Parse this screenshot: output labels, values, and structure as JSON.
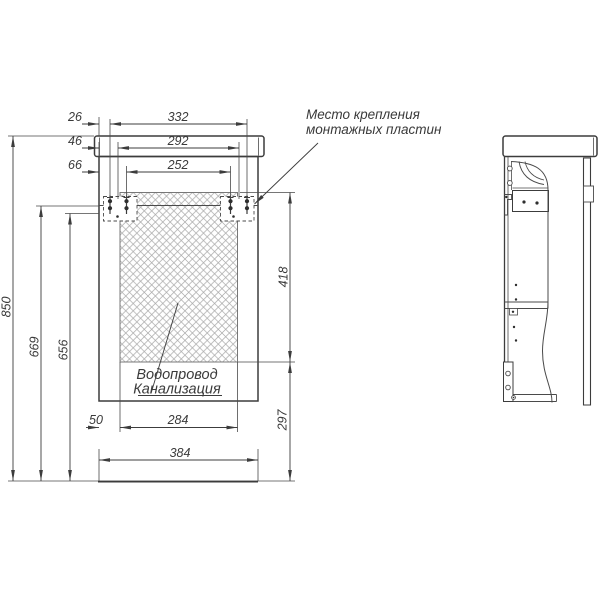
{
  "drawing": {
    "type": "technical-drawing",
    "subject": "wall-hung bathroom vanity installation drawing (front and side views)",
    "background": "#ffffff",
    "colors": {
      "line": "#3c3c3c",
      "thin_line": "#4a4a4a",
      "hatch": "#a8a8a8",
      "text": "#3a3a3a"
    },
    "annotations": {
      "mounting_note_line1": "Место крепления",
      "mounting_note_line2": "монтажных пластин",
      "utility_zone_line1": "Водопровод",
      "utility_zone_line2": "Канализация"
    },
    "dimensions": {
      "offset_outer_screw": "26",
      "span_outer_screws": "332",
      "offset_plate_edge": "46",
      "span_plate_edges": "292",
      "offset_inner_screw": "66",
      "span_inner_screws": "252",
      "height_total": "850",
      "height_mount_upper": "669",
      "height_mount_lower": "656",
      "utility_zone_height": "418",
      "utility_zone_floor_offset": "297",
      "utility_offset_left": "50",
      "utility_zone_width": "284",
      "cabinet_width": "384"
    }
  }
}
